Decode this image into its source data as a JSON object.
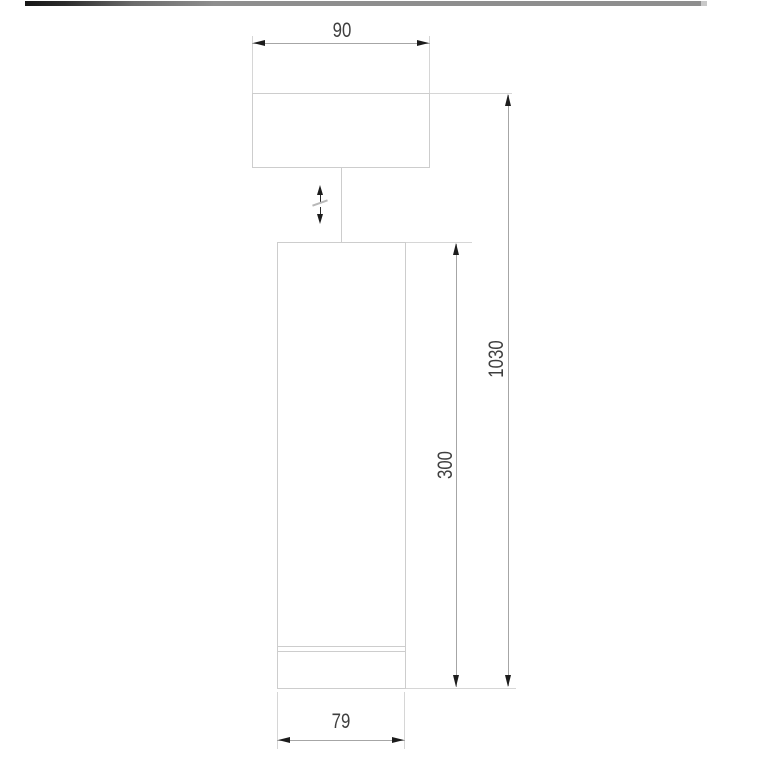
{
  "window": {
    "description": "Technical dimension drawing of a cylindrical pendant ceiling lamp with adjustable suspension"
  },
  "top_bar": {
    "gradient_left": "#161616",
    "gradient_right": "#8e8e8e"
  },
  "drawing": {
    "colors": {
      "background": "#ffffff",
      "outline": "#cdcdcd",
      "extension_line": "#d6d6d6",
      "dimension_line": "#a6a6a6",
      "arrowhead": "#1c1c1c",
      "text": "#3f3f3f"
    },
    "labels": {
      "canopy_width": "90",
      "overall_height": "1030",
      "body_height": "300",
      "body_diameter": "79"
    },
    "symbols": {
      "adjustable_height": "vertical-double-arrow-with-break"
    }
  }
}
